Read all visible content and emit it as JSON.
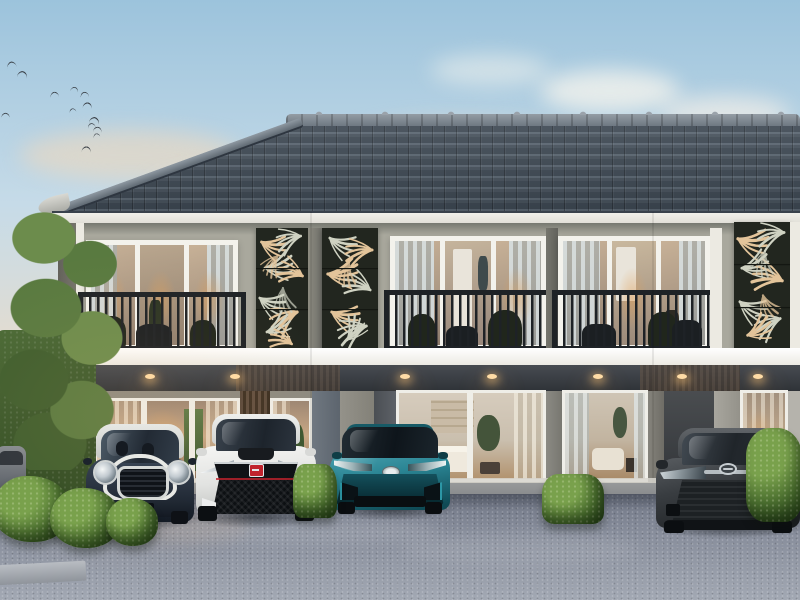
{
  "image": {
    "description": "3D exterior rendering of a modern two-storey townhouse row at dusk; four cars parked on a concrete driveway, decorative laser-cut leaf screens between balconies, birds in the sky, trees and hedges at the edges",
    "visible_text": "none"
  },
  "palette": {
    "sky_top": "#9cc3dc",
    "sky_mid": "#c6dbe8",
    "sky_low": "#e3ddd2",
    "sky_horizon": "#f0dfc8",
    "bird": "#3a4047",
    "roof_dark": "#3d4853",
    "roof_mid": "#47525d",
    "roof_light": "#5a6672",
    "ridge": "#949ca4",
    "fascia": "#f1f0ea",
    "wall_upper": "#a9a89d",
    "wall_corner": "#6f6e64",
    "trim_white": "#f3f2ec",
    "railing": "#1e2226",
    "panel_bg": "#22261f",
    "panel_leaf_gold": "#e3c49a",
    "panel_leaf_sage": "#cfd2c2",
    "glass_warm_hi": "#c7b197",
    "glass_warm_lo": "#8e7c6c",
    "glassdoor_warm": "#c8a885",
    "slab": "#eceae3",
    "porch_ceiling": "#474b51",
    "downlight": "#ffdca6",
    "wall_ground": "#8d8a80",
    "pier_blue": "#6e7781",
    "pier_gray": "#94928a",
    "wood_light": "#6b5746",
    "wood_dark": "#473828",
    "recess_dark": "#3a3d40",
    "drive_dark": "#6f7584",
    "drive_mid": "#868c9a",
    "drive_light": "#a2a8b3",
    "curb": "#b9bdc3",
    "hedge": "#4c7030",
    "hedge_light": "#79a14c",
    "tree_a": "#597a40",
    "tree_b": "#6c8c4c",
    "tree_c": "#3f5e2e"
  },
  "sky": {
    "birds": [
      {
        "x": 7,
        "y": 62,
        "s": 1.1,
        "r": -12
      },
      {
        "x": 18,
        "y": 72,
        "s": 1.2,
        "r": 8
      },
      {
        "x": 50,
        "y": 92,
        "s": 1.0,
        "r": -5
      },
      {
        "x": 70,
        "y": 87,
        "s": 0.9,
        "r": 14
      },
      {
        "x": 80,
        "y": 92,
        "s": 1.0,
        "r": -10
      },
      {
        "x": 83,
        "y": 103,
        "s": 1.1,
        "r": 5
      },
      {
        "x": 1,
        "y": 113,
        "s": 1.0,
        "r": 0
      },
      {
        "x": 68,
        "y": 108,
        "s": 0.8,
        "r": -16
      },
      {
        "x": 90,
        "y": 118,
        "s": 1.2,
        "r": 10
      },
      {
        "x": 87,
        "y": 123,
        "s": 0.9,
        "r": -6
      },
      {
        "x": 93,
        "y": 127,
        "s": 1.0,
        "r": 4
      },
      {
        "x": 92,
        "y": 133,
        "s": 0.8,
        "r": -12
      },
      {
        "x": 82,
        "y": 147,
        "s": 1.1,
        "r": 6
      }
    ]
  },
  "building": {
    "storeys": 2,
    "balconies": 3,
    "decorative_screen_panels": 3,
    "downlight_x": [
      150,
      235,
      405,
      492,
      598,
      682,
      758
    ]
  },
  "cars": [
    {
      "name": "mini-cooper-hatchback",
      "body": "#2a3340",
      "roof": "#c6c8c4",
      "trim": "#e8e9e5"
    },
    {
      "name": "honda-civic-type-r",
      "body": "#e2e3e1",
      "badge": "#c0232d"
    },
    {
      "name": "toyota-prius",
      "body": "#2a8493",
      "accent": "#0f4a55"
    },
    {
      "name": "toyota-camry",
      "body": "#393d41",
      "accent": "#1b1e21"
    }
  ],
  "landscape": {
    "bushes": [
      {
        "x": -8,
        "y": 476,
        "w": 78,
        "h": 66,
        "variant": "round"
      },
      {
        "x": 50,
        "y": 488,
        "w": 70,
        "h": 60,
        "variant": "round"
      },
      {
        "x": 106,
        "y": 498,
        "w": 52,
        "h": 48,
        "variant": "round"
      },
      {
        "x": 293,
        "y": 464,
        "w": 44,
        "h": 54,
        "variant": "box"
      },
      {
        "x": 542,
        "y": 474,
        "w": 62,
        "h": 50,
        "variant": "box"
      },
      {
        "x": 746,
        "y": 428,
        "w": 56,
        "h": 94,
        "variant": "tall"
      }
    ]
  }
}
